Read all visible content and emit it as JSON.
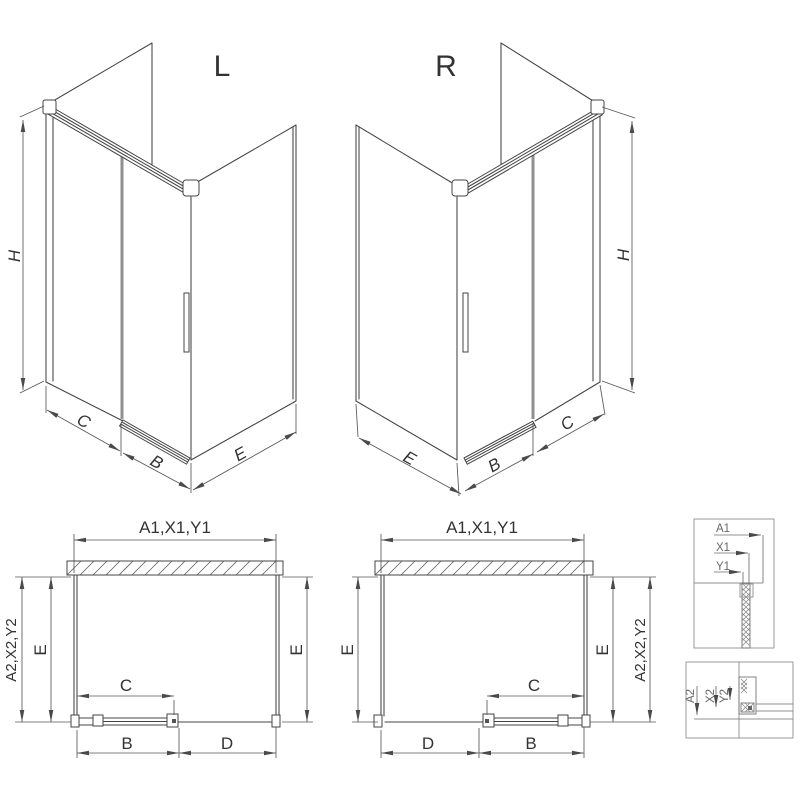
{
  "drawing": {
    "variant_left_label": "L",
    "variant_right_label": "R",
    "iso_left": {
      "height": "H",
      "front_fixed": "C",
      "front_door": "B",
      "side": "E"
    },
    "iso_right": {
      "height": "H",
      "front_fixed": "C",
      "front_door": "B",
      "side": "E"
    },
    "plan_left": {
      "top_width": "A1,X1,Y1",
      "outer_depth": "A2,X2,Y2",
      "depth_left": "E",
      "depth_right": "E",
      "door_width": "C",
      "bottom_left": "B",
      "bottom_right": "D"
    },
    "plan_right": {
      "top_width": "A1,X1,Y1",
      "outer_depth": "A2,X2,Y2",
      "depth_left": "E",
      "depth_right": "E",
      "door_width": "C",
      "bottom_left": "D",
      "bottom_right": "B"
    },
    "detail_top": {
      "labels": [
        "A1",
        "X1",
        "Y1"
      ]
    },
    "detail_bottom": {
      "labels": [
        "A2",
        "X2",
        "Y2"
      ]
    },
    "colors": {
      "line": "#444444",
      "dim": "#575757",
      "door_glass": "#8f8f8f",
      "detail": "#8f8f8f",
      "text": "#333333",
      "background": "#ffffff"
    }
  }
}
